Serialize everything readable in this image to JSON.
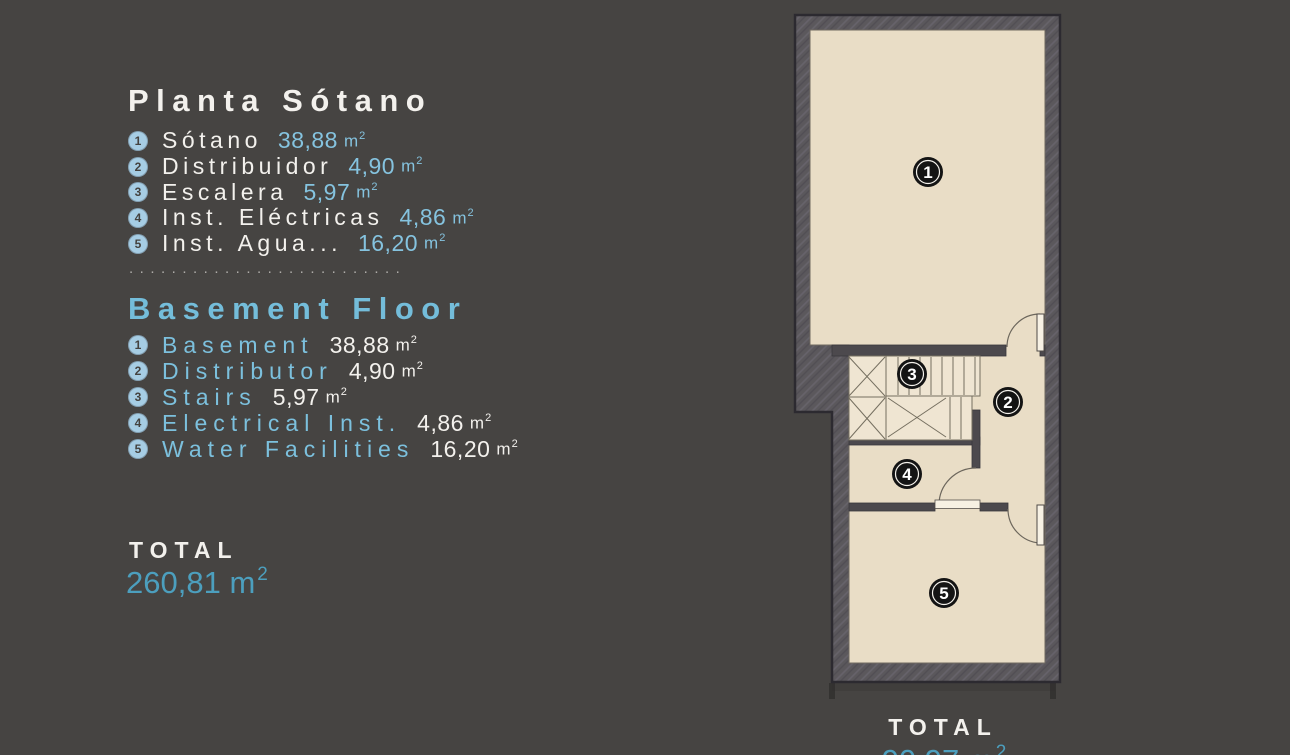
{
  "left_panel": {
    "spanish": {
      "title": "Planta Sótano",
      "items": [
        {
          "num": "1",
          "label": "Sótano",
          "value": "38,88"
        },
        {
          "num": "2",
          "label": "Distribuidor",
          "value": "4,90"
        },
        {
          "num": "3",
          "label": "Escalera",
          "value": "5,97"
        },
        {
          "num": "4",
          "label": "Inst. Eléctricas",
          "value": "4,86"
        },
        {
          "num": "5",
          "label": "Inst. Agua...",
          "value": "16,20"
        }
      ]
    },
    "separator": "..........................",
    "english": {
      "title": "Basement Floor",
      "items": [
        {
          "num": "1",
          "label": "Basement",
          "value": "38,88"
        },
        {
          "num": "2",
          "label": "Distributor",
          "value": "4,90"
        },
        {
          "num": "3",
          "label": "Stairs",
          "value": "5,97"
        },
        {
          "num": "4",
          "label": "Electrical Inst.",
          "value": "4,86"
        },
        {
          "num": "5",
          "label": "Water Facilities",
          "value": "16,20"
        }
      ]
    },
    "total": {
      "label": "TOTAL",
      "value": "260,81"
    }
  },
  "unit": {
    "base": "m",
    "sup": "2"
  },
  "floor_plan": {
    "room_markers": [
      {
        "num": "1"
      },
      {
        "num": "2"
      },
      {
        "num": "3"
      },
      {
        "num": "4"
      },
      {
        "num": "5"
      }
    ],
    "total": {
      "label": "TOTAL",
      "value": "90,97"
    }
  },
  "colors": {
    "background": "#464442",
    "accent_blue": "#7cc0dd",
    "accent_teal": "#4c9fbe",
    "floor_beige": "#e9ddc6",
    "wall_gray": "#5b585c"
  }
}
